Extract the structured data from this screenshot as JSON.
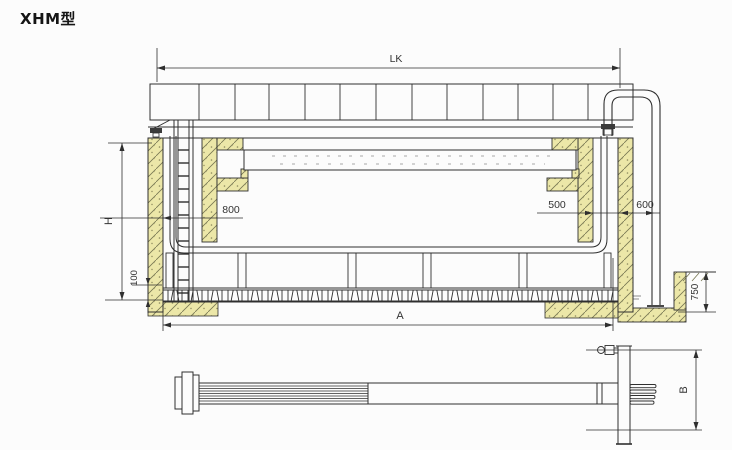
{
  "title": "XHM型",
  "labels": {
    "lk": "LK",
    "h": "H",
    "hundred": "100",
    "eight_hundred": "800",
    "five_hundred": "500",
    "six_hundred": "600",
    "a": "A",
    "seven_fifty": "750",
    "b": "B"
  },
  "colors": {
    "line": "#2f2f2f",
    "masonry_fill": "#ece7a8",
    "hatch": "#777753",
    "background": "#fcfcfc",
    "dim_text": "#333333"
  }
}
